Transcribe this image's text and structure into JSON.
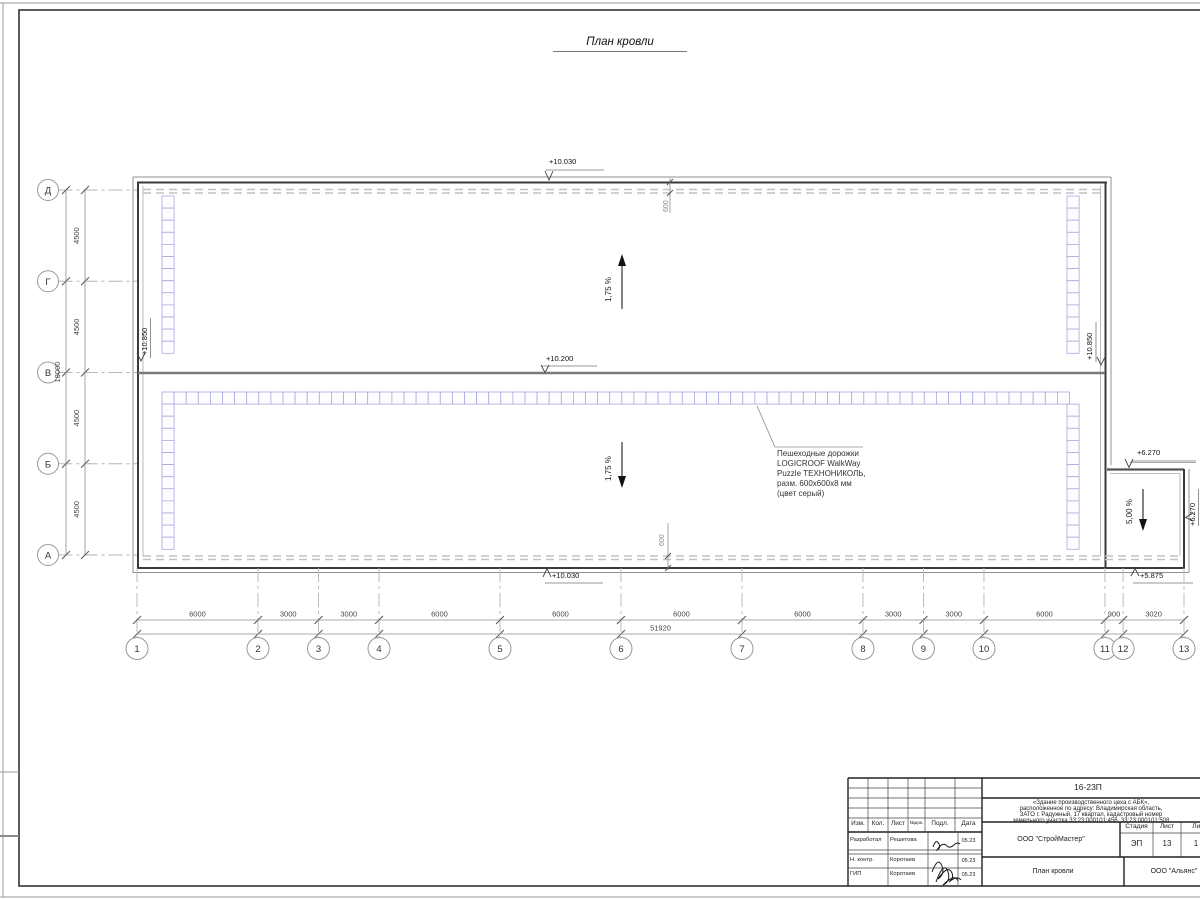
{
  "sheet": {
    "title": "План кровли"
  },
  "colors": {
    "walkway_tile": "#aaaadd",
    "line_dark": "#3a3a3a"
  },
  "plan": {
    "elevations": {
      "top": "+10.030",
      "ridge": "+10.200",
      "bottom": "+10.030",
      "left_wall": "+10.850",
      "right_wall": "+10.850",
      "annex_top": "+6.270",
      "annex_right": "+6.270",
      "annex_bottom": "+5.875"
    },
    "slopes": {
      "upper": "1,75 %",
      "lower": "1,75 %",
      "annex": "5,00 %"
    },
    "offsets": {
      "top": "600",
      "bottom": "600"
    },
    "walkway_note": {
      "lines": [
        "Пешеходные дорожки",
        "LOGICROOF WalkWay",
        "Puzzle ТЕХНОНИКОЛЬ,",
        "разм. 600х600х8 мм",
        "(цвет серый)"
      ]
    },
    "axes": {
      "rows": [
        "Д",
        "Г",
        "В",
        "Б",
        "А"
      ],
      "row_dims": [
        "4500",
        "4500",
        "4500",
        "4500"
      ],
      "row_total": "18000",
      "cols": [
        "1",
        "2",
        "3",
        "4",
        "5",
        "6",
        "7",
        "8",
        "9",
        "10",
        "11",
        "12",
        "13"
      ],
      "col_dims": [
        "6000",
        "3000",
        "3000",
        "6000",
        "6000",
        "6000",
        "6000",
        "3000",
        "3000",
        "6000",
        "900",
        "3020"
      ],
      "col_total": "51920"
    }
  },
  "stamp": {
    "doc_code": "16-23П",
    "project_lines": [
      "«Здание производственного цеха с АБК»,",
      "расположенное по адресу: Владимирская область,",
      "ЗАТО г. Радужный, 17 квартал, кадастровый номер",
      "земельного участка 33:23:000101:456, 33:23:000101:508"
    ],
    "header_cols": [
      "Изм.",
      "Кол.",
      "Лист",
      "№док.",
      "Подл.",
      "Дата"
    ],
    "rows": [
      {
        "role": "Разработал",
        "name": "Решетова",
        "date": "05.23"
      },
      {
        "role": "Н. контр.",
        "name": "Коротаев",
        "date": "05.23"
      },
      {
        "role": "ГИП",
        "name": "Коротаев",
        "date": "05.23"
      }
    ],
    "org1": "ООО \"СтройМастер\"",
    "stage_label": "Стадия",
    "sheet_label": "Лист",
    "sheets_label": "Листов",
    "stage": "ЭП",
    "sheet_no": "13",
    "sheets_total": "1",
    "drawing_title": "План кровли",
    "org2": "ООО \"Альянс\""
  }
}
